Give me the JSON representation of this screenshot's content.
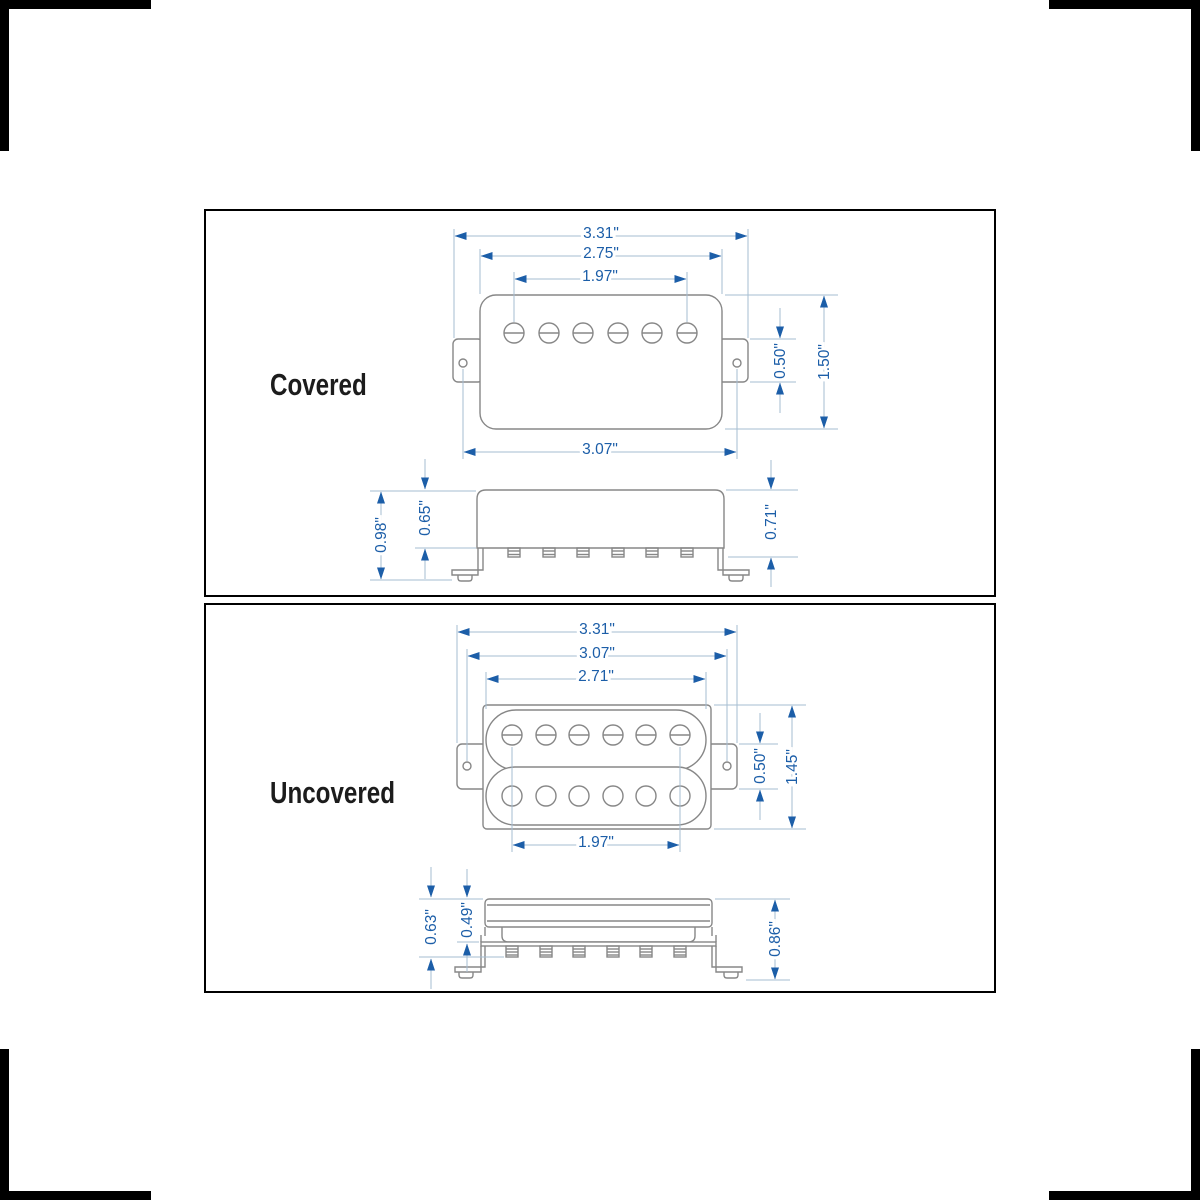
{
  "colors": {
    "background": "#ffffff",
    "panel_border": "#000000",
    "drawing_outline": "#878787",
    "dimension_line": "#a6bdd2",
    "dimension_accent": "#1c5ea8",
    "title_text": "#1c1c1c"
  },
  "panels": [
    {
      "title": "Covered",
      "dimensions": {
        "overall_width": "3.31\"",
        "cover_width": "2.75\"",
        "pole_spacing": "1.97\"",
        "mounting_width": "3.07\"",
        "ear_height": "0.50\"",
        "body_height": "1.50\"",
        "total_depth": "0.98\"",
        "cover_depth": "0.65\"",
        "base_depth": "0.71\""
      }
    },
    {
      "title": "Uncovered",
      "dimensions": {
        "overall_width": "3.31\"",
        "mounting_width": "3.07\"",
        "bobbin_width": "2.71\"",
        "pole_spacing": "1.97\"",
        "ear_height": "0.50\"",
        "body_height": "1.45\"",
        "total_depth": "0.63\"",
        "bobbin_depth": "0.49\"",
        "base_depth": "0.86\""
      }
    }
  ]
}
